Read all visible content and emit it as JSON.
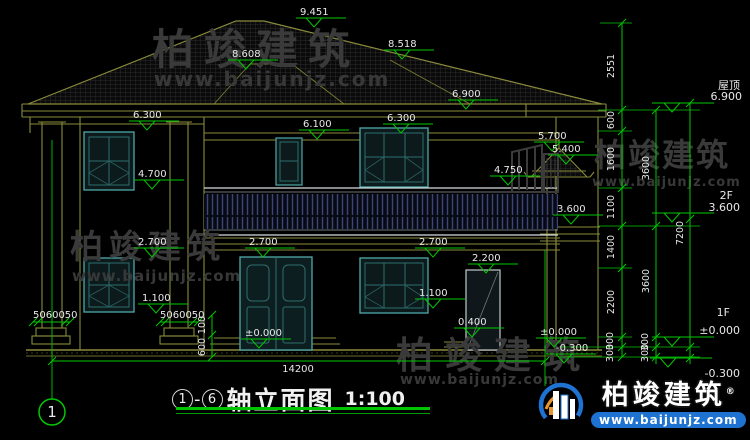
{
  "drawing": {
    "title": {
      "axis_start": "1",
      "separator": "-",
      "axis_end": "6",
      "name": "轴立面图",
      "scale": "1:100"
    },
    "axis_bubble": "1",
    "levels": {
      "peak": "9.451",
      "hip_left": "8.608",
      "hip_right": "8.518",
      "right_eave": "6.900",
      "left_eave": "6.300",
      "mid_eave": "6.100",
      "f2_window_top": "6.300",
      "porch_ridge": "5.700",
      "porch_eave": "5.400",
      "porch_beam": "4.750",
      "f2_left_window_top": "4.700",
      "balcony_floor": "3.600",
      "f1_lintel_left": "2.700",
      "f1_lintel_center": "2.700",
      "f1_lintel_right": "2.700",
      "side_door_top": "2.200",
      "f1_sill_left": "1.100",
      "f1_sill_right": "1.100",
      "side_step_top": "0.400",
      "floor_zero_main": "±0.000",
      "floor_zero_right": "±0.000",
      "ground_level": "-0.300"
    },
    "right_levels": {
      "roof_label": "屋顶",
      "roof_value": "6.900",
      "f2_label": "2F",
      "f2_value": "3.600",
      "f1_label": "1F",
      "f1_value": "±0.000",
      "ground_value": "-0.300"
    },
    "right_dim_chain": [
      "2551",
      "600",
      "1600",
      "1100",
      "1400",
      "2200",
      "300",
      "300"
    ],
    "right_floor_chain": [
      "3600",
      "3600",
      "300",
      "300"
    ],
    "right_total": "7200",
    "bottom_dims": {
      "total_width": "14200",
      "column_base_left": "5060050",
      "column_base_right": "5060050",
      "step_upper": "100",
      "step_lower": "600"
    }
  },
  "watermark": {
    "brand": "柏竣建筑",
    "url": "www.baijunjz.com"
  },
  "logo": {
    "brand": "柏竣建筑",
    "registered": "®",
    "url": "www.baijunjz.com"
  },
  "colors": {
    "dimension_green": "#00c800",
    "structure_olive": "#8a8a3c",
    "window_teal": "#2e6d6d",
    "logo_blue": "#1d72d2",
    "background": "#000000"
  }
}
